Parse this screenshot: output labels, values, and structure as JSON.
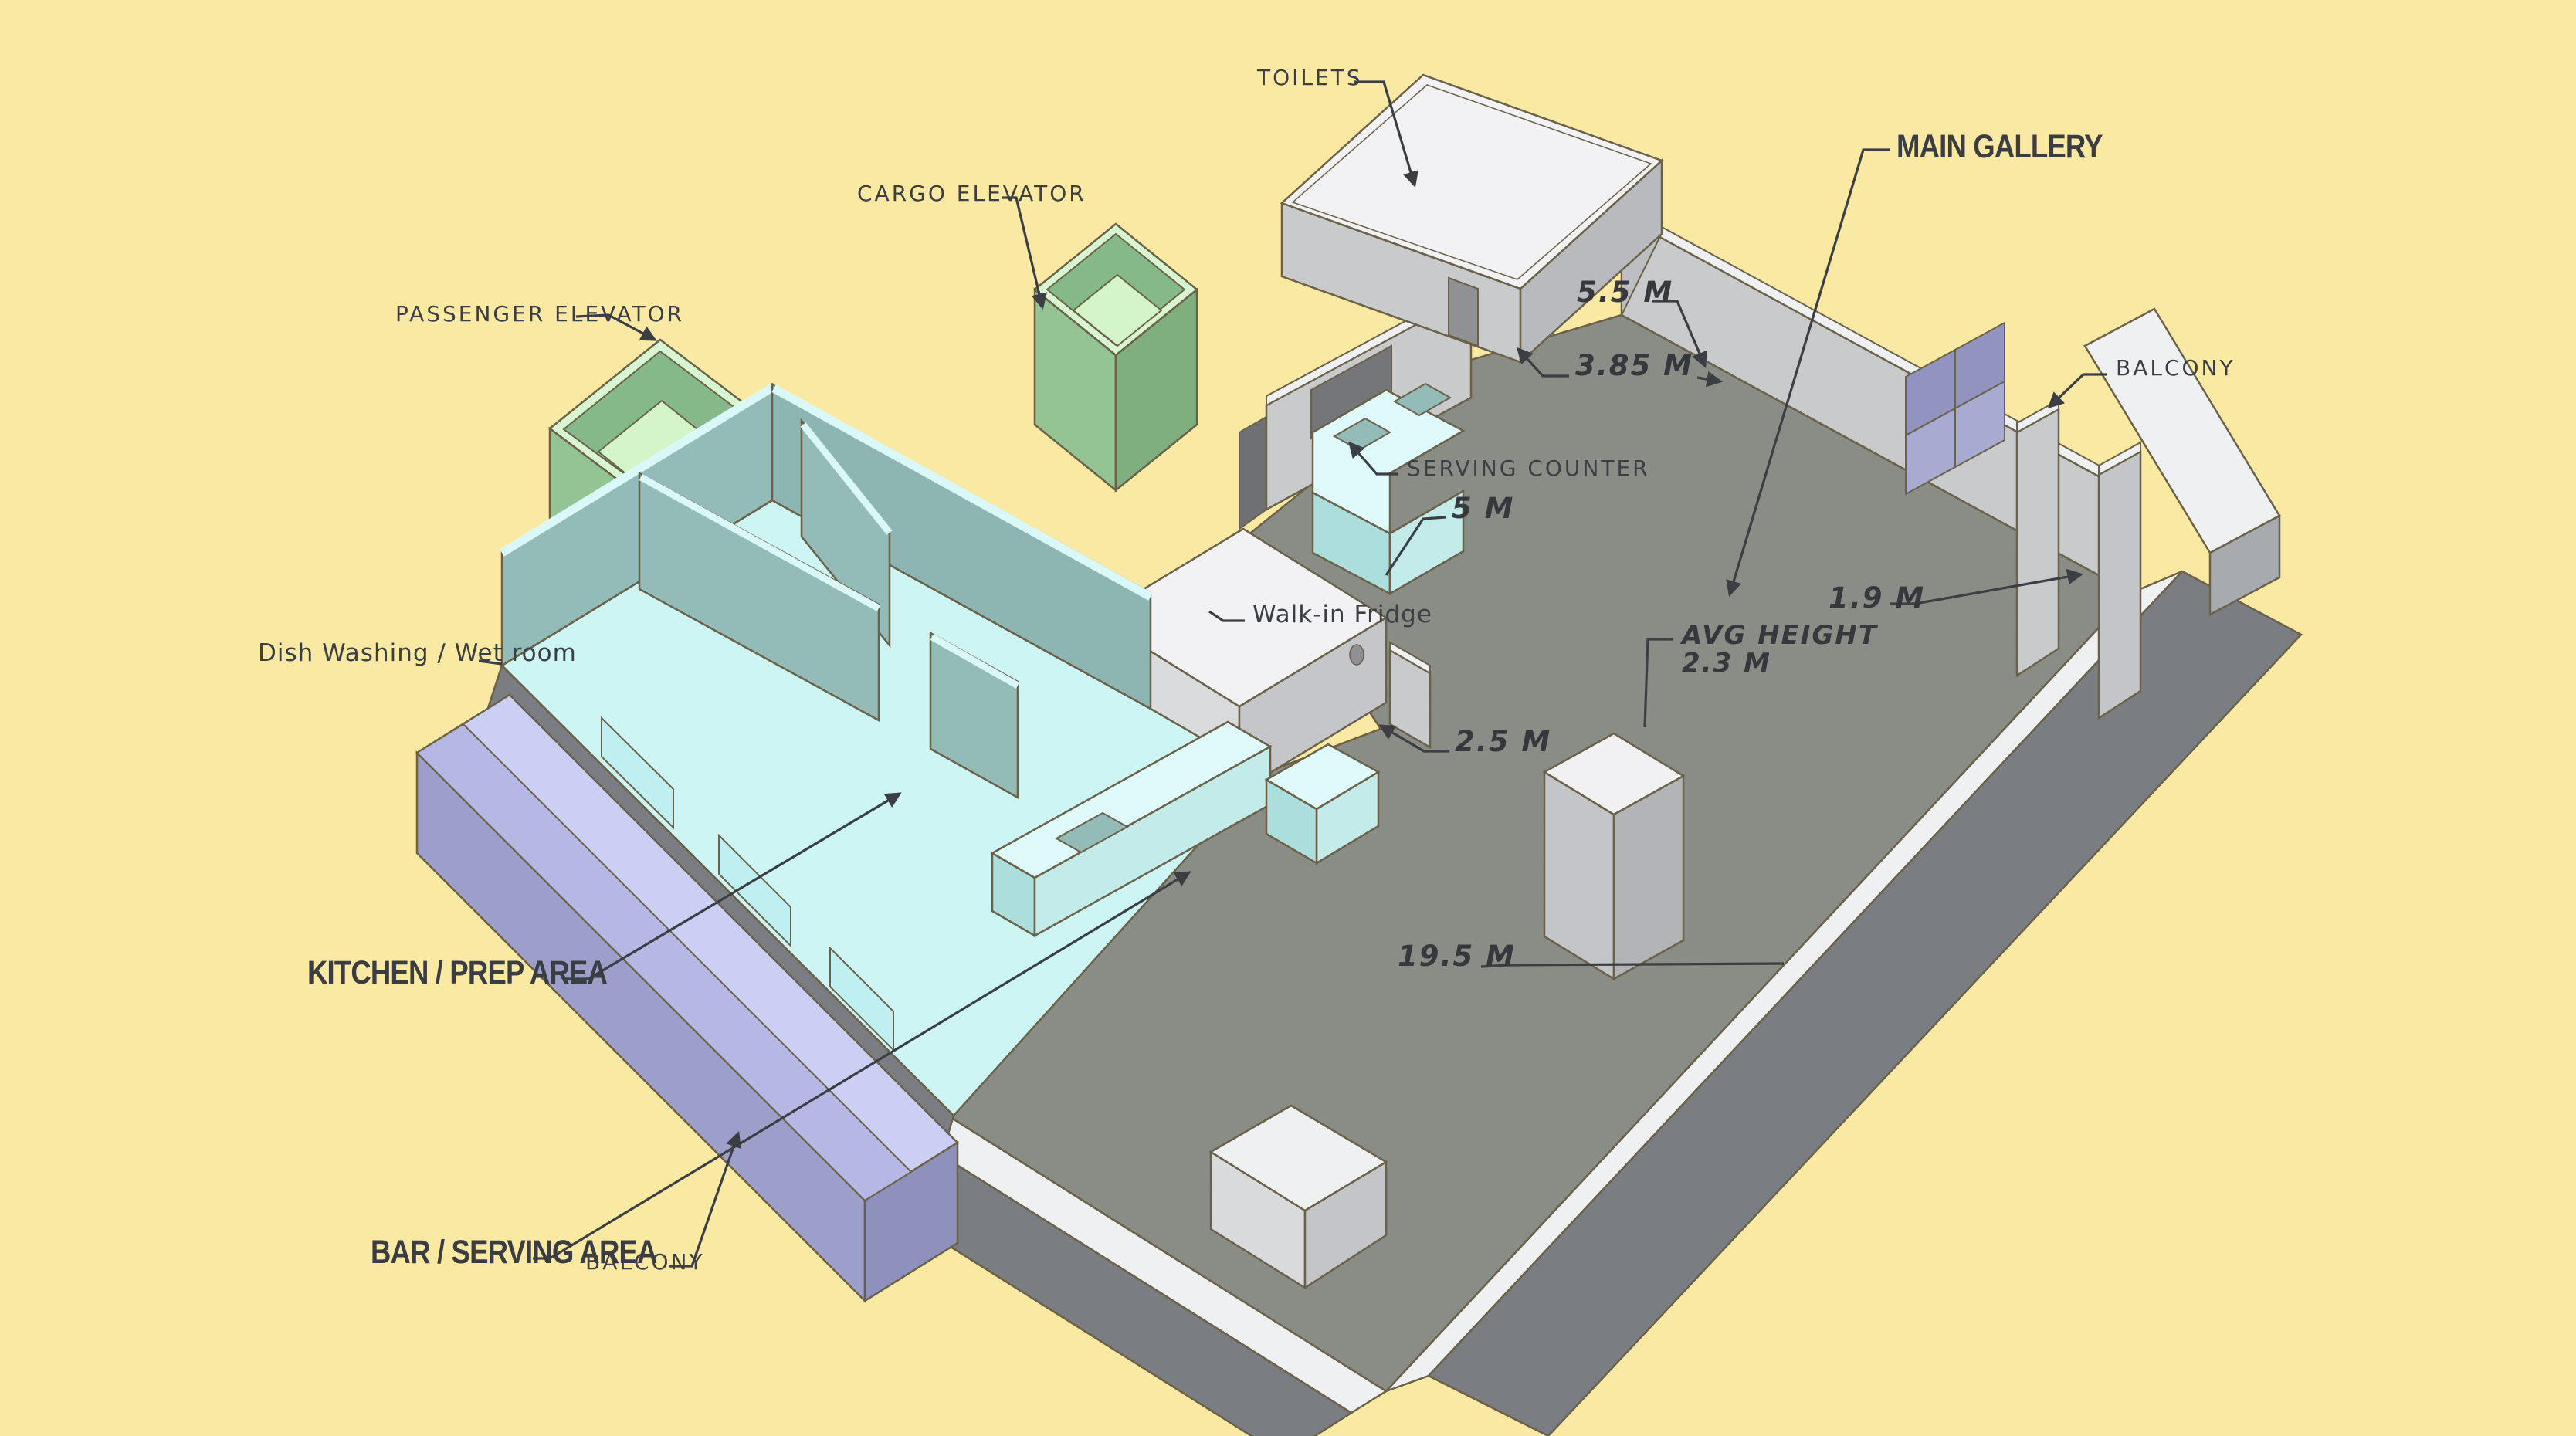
{
  "diagram_title": "Venue floor diagram (isometric)",
  "labels": {
    "toilets": "TOILETS",
    "cargo_elevator": "CARGO ELEVATOR",
    "passenger_elevator": "PASSENGER ELEVATOR",
    "main_gallery": "MAIN GALLERY",
    "balcony_right": "BALCONY",
    "serving_counter": "SERVING COUNTER",
    "walk_in_fridge": "Walk-in Fridge",
    "dish_washing": "Dish Washing / Wet room",
    "kitchen": "KITCHEN / PREP AREA",
    "bar": "BAR / SERVING AREA",
    "balcony_bottom": "BALCONY"
  },
  "measurements": {
    "gallery_width_top": "5.5 M",
    "toilet_wall": "3.85 M",
    "serving_wall": "5 M",
    "kitchen_door": "2.5 M",
    "gallery_length": "19.5 M",
    "door_width": "1.9 M",
    "avg_height_label": "AVG HEIGHT",
    "avg_height_value": "2.3 M"
  },
  "colors": {
    "background": "#FAE9A2",
    "ink": "#3B3E43",
    "outline": "#6A6148",
    "gallery_floor": "#8C8F88",
    "wall_light": "#C9CACC",
    "wall_mid": "#B9BABE",
    "wall_dark": "#7A7D81",
    "white_trim": "#EFF0F2",
    "elevator_green": "#94C494",
    "elevator_green_dark": "#7FAE7F",
    "elevator_floor": "#D4F5CA",
    "kitchen_teal": "#93BCB9",
    "kitchen_floor_cyan": "#CCF5F3",
    "counter_cyan": "#C2EBEA",
    "balcony_purple": "#9C9FC9",
    "balcony_purple_top": "#CCCFF4",
    "window_pane": "#9094BF"
  }
}
